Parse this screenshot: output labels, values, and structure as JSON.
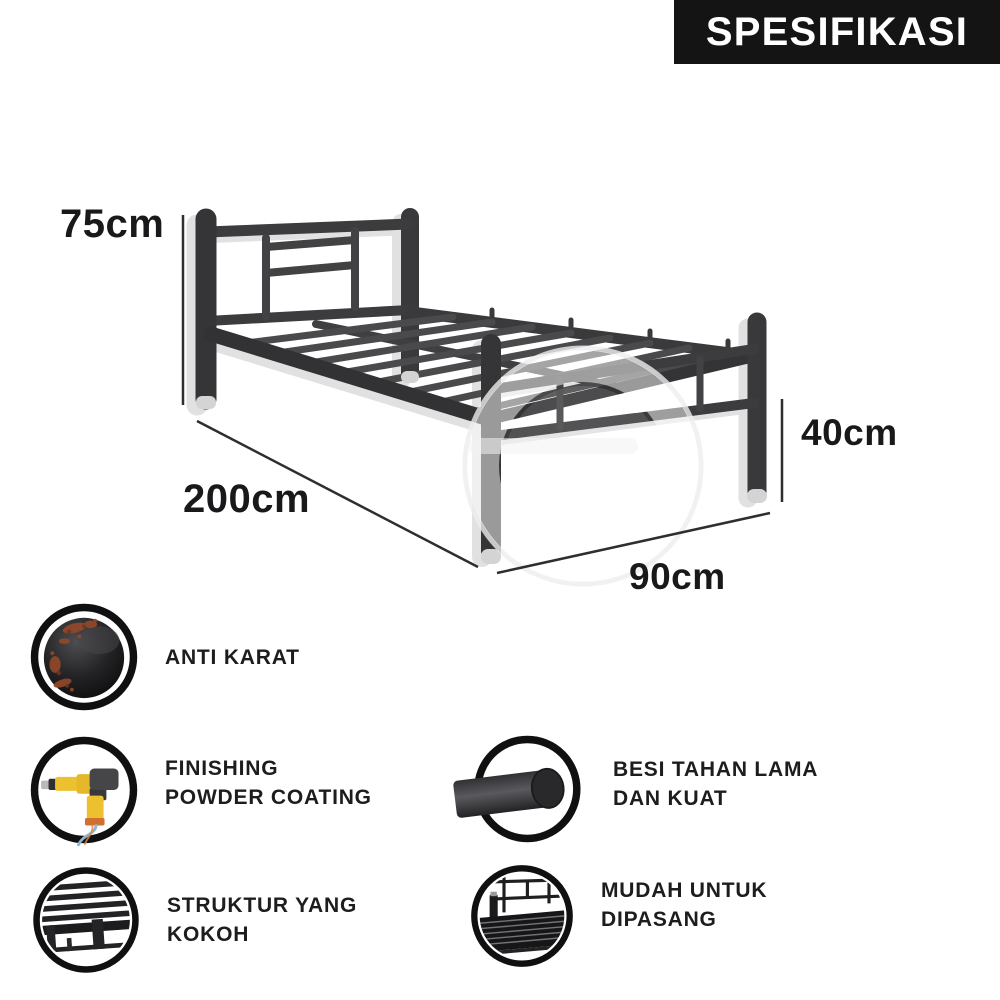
{
  "banner": {
    "title": "SPESIFIKASI",
    "bg": "#141414",
    "fg": "#ffffff"
  },
  "diagram": {
    "product": "metal single bed frame",
    "headboard_height": "75cm",
    "length": "200cm",
    "footboard_height": "40cm",
    "width": "90cm"
  },
  "features": [
    {
      "icon": "rust-globe-icon",
      "line1": "ANTI KARAT"
    },
    {
      "icon": "spray-gun-icon",
      "line1": "FINISHING",
      "line2": "POWDER COATING"
    },
    {
      "icon": "metal-rod-icon",
      "line1": "BESI TAHAN LAMA",
      "line2": "DAN KUAT"
    },
    {
      "icon": "frame-structure-icon",
      "line1": "STRUKTUR YANG",
      "line2": "KOKOH"
    },
    {
      "icon": "bed-assembly-icon",
      "line1": "MUDAH UNTUK",
      "line2": "DIPASANG"
    }
  ],
  "colors": {
    "banner_bg": "#141414",
    "banner_fg": "#ffffff",
    "label_text": "#1d1d1f",
    "tube_dark": "#3c3c3e",
    "tube_shadow": "#c9c9c9",
    "rust_patch": "#94482a",
    "gun_yellow": "#edc02f",
    "gun_orange": "#cf7030",
    "cable_blue": "#8fb3cf"
  }
}
